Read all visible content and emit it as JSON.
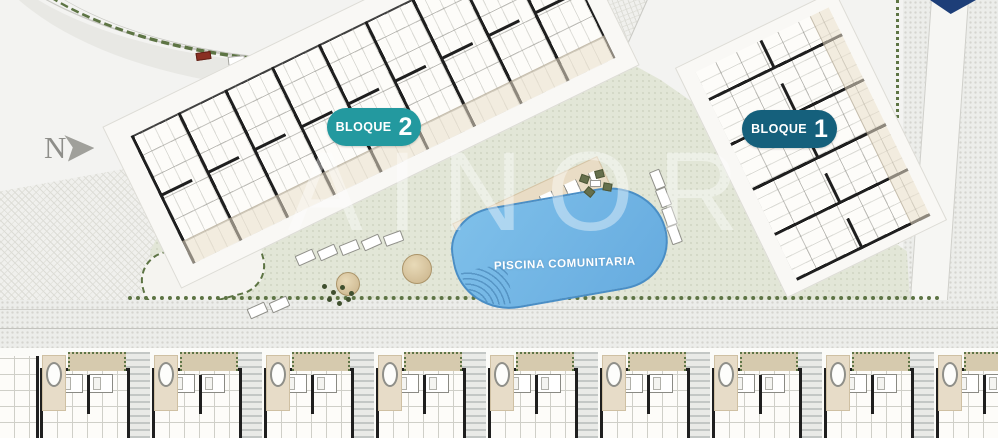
{
  "plan": {
    "compass": "N",
    "watermark": "AINOR",
    "blocks": [
      {
        "label": "BLOQUE",
        "number": "2"
      },
      {
        "label": "BLOQUE",
        "number": "1"
      }
    ],
    "pool_label": "PISCINA COMUNITARIA",
    "villa_count": 9,
    "colors": {
      "block2_pill": "#23999f",
      "block1_pill": "#15607c",
      "pool": "#6fb2e2",
      "lawn": "#e2e6d7",
      "hedge": "#5d7444",
      "corner_triangle": "#1d3e78"
    }
  }
}
